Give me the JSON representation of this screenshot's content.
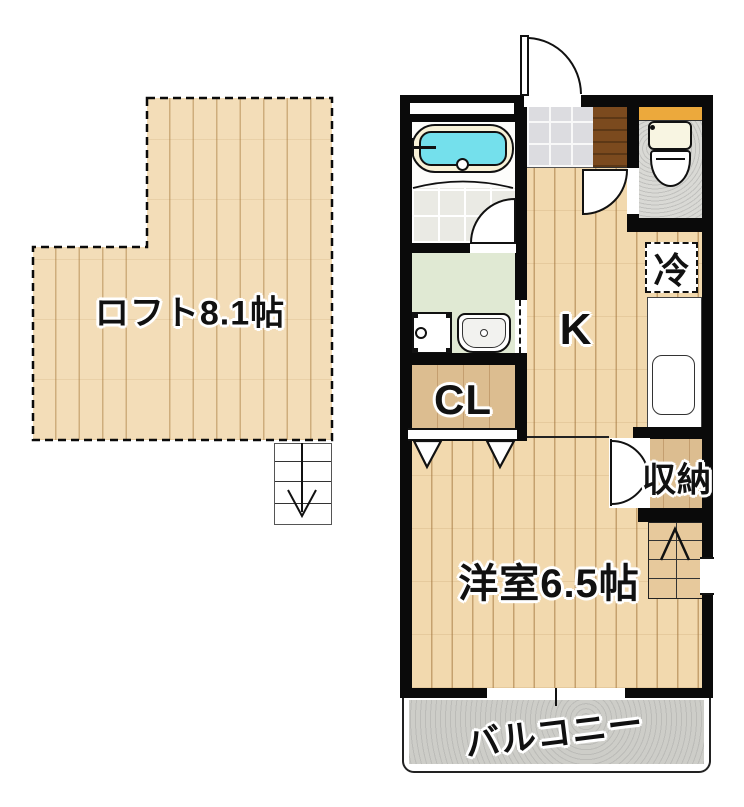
{
  "plan": {
    "loft": {
      "label": "ロフト8.1帖"
    },
    "rooms": {
      "kitchen": "K",
      "closet": "CL",
      "refrigerator": "冷",
      "storage": "収納",
      "western_room": "洋室6.5帖",
      "balcony": "バルコニー"
    },
    "icons": {
      "loft_stairs": "down-arrow-stairs",
      "main_stairs": "up-arrow-stairs"
    }
  },
  "colors": {
    "wall": "#0a0a0a",
    "wood_floor": "#f2d9ae",
    "loft_wood": "#f3ddb8",
    "closet_wood": "#dcbd90",
    "stairs_wood": "#e7c99c",
    "entry_tile": "#dcdce0",
    "step_brown": "#7b4a1e",
    "bath_water": "#74e0ec",
    "tub_rim": "#f8f2d8",
    "bath_tile": "#eaeae4",
    "washroom_green": "#e0e9d3",
    "toilet_floor": "#d9d9d5",
    "toilet_counter": "#eca93c",
    "balcony_floor": "#cdcdc8"
  }
}
